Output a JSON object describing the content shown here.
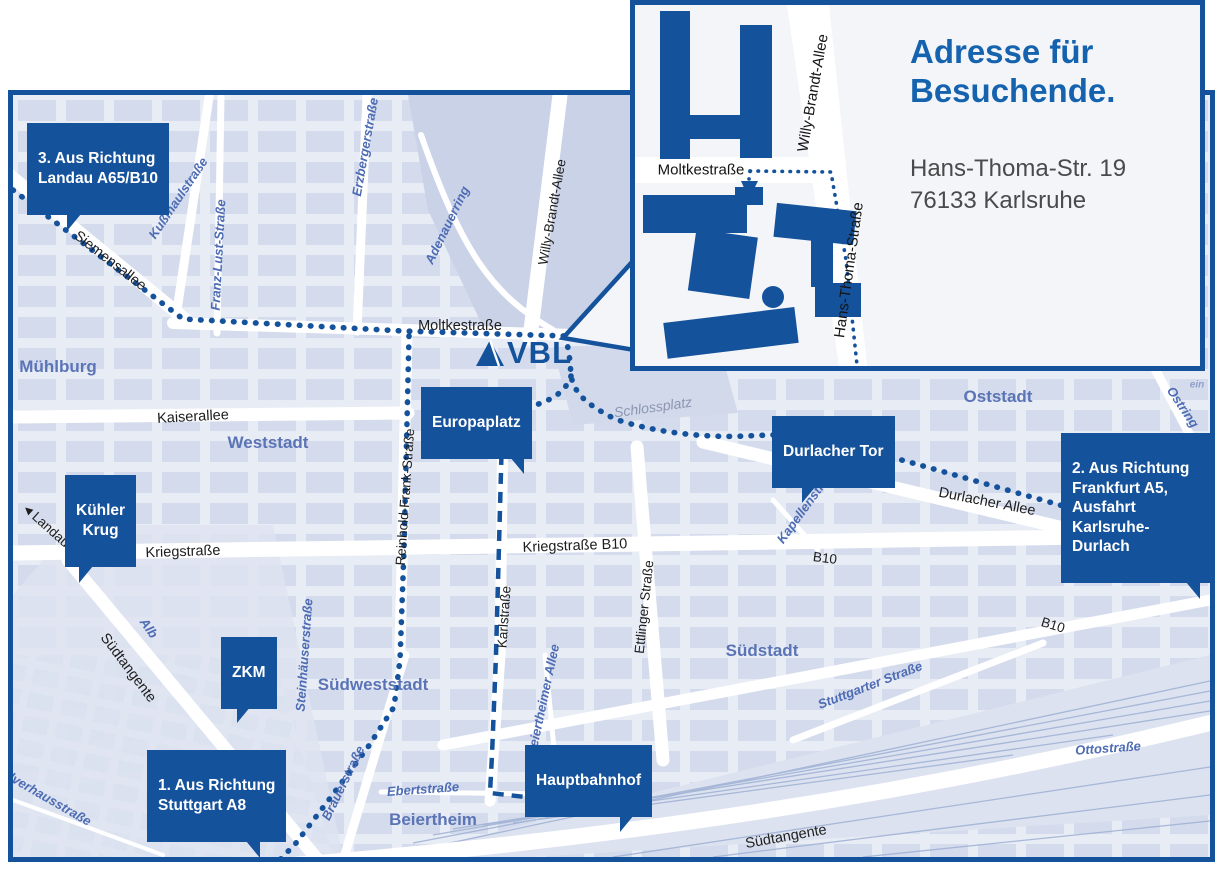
{
  "colors": {
    "accent": "#15529c",
    "title_blue": "#1563ae",
    "map_bg": "#e8ecf5",
    "block": "#cfd7ea",
    "street_blue_text": "#4d6cb4",
    "district_text": "#5b74b6"
  },
  "inset": {
    "title": "Adresse für\nBesuchende.",
    "address_line1": "Hans-Thoma-Str. 19",
    "address_line2": "76133 Karlsruhe",
    "streets": {
      "moltkestrasse": "Moltkestraße",
      "willy_brandt_allee": "Willy-Brandt-Allee",
      "hans_thoma_strasse": "Hans-Thoma-Straße"
    },
    "entrance_arrow": "▼"
  },
  "logo": {
    "text": "VBL"
  },
  "callouts": {
    "route3": "3. Aus Richtung\nLandau A65/B10",
    "route1": "1. Aus Richtung\nStuttgart A8",
    "route2": "2. Aus Richtung\nFrankfurt A5,\nAusfahrt\nKarlsruhe-Durlach",
    "kuehler_krug": "Kühler\nKrug",
    "zkm": "ZKM",
    "europaplatz": "Europaplatz",
    "durlacher_tor": "Durlacher Tor",
    "hauptbahnhof": "Hauptbahnhof"
  },
  "streets_black": {
    "siemensallee": "Siemensallee",
    "moltkestrasse": "Moltkestraße",
    "kaiserallee": "Kaiserallee",
    "kriegstrasse": "Kriegstraße",
    "kriegstrasse_b10": "Kriegstraße B10",
    "b10": "B10",
    "reinhold_frank_strasse": "Reinhold-Frank-Straße",
    "karlstrasse": "Karlstraße",
    "ettlinger_strasse": "Ettlinger Straße",
    "willy_brandt_allee": "Willy-Brandt-Allee",
    "durlacher_allee": "Durlacher Allee",
    "suedtangente": "Südtangente",
    "landau_b10": "Landau B10",
    "landau_arrow": "◀"
  },
  "streets_blue": {
    "kussmaulstrasse": "Kußmaulstraße",
    "franz_lust_strasse": "Franz-Lust-Straße",
    "erzbergerstrasse": "Erzbergerstraße",
    "adenauerring": "Adenauerring",
    "kapellenstrasse": "Kapellenstraße",
    "ostring": "Ostring",
    "steinhaeuserstrasse": "Steinhäuserstraße",
    "brauerstrasse": "Brauerstraße",
    "ebertstrasse": "Ebertstraße",
    "beiertheimer_allee": "Beiertheimer Allee",
    "stuttgarter_strasse": "Stuttgarter Straße",
    "ottostrasse": "Ottostraße",
    "alb": "Alb",
    "pulverhausstrasse": "Pulverhausstraße"
  },
  "places_gray": {
    "schlossplatz": "Schlossplatz"
  },
  "districts": {
    "muehlburg": "Mühlburg",
    "weststadt": "Weststadt",
    "oststadt": "Oststadt",
    "suedstadt": "Südstadt",
    "suedweststadt": "Südweststadt",
    "beiertheim": "Beiertheim"
  },
  "edge_fragments": {
    "f1": "Hai",
    "f2": "we",
    "f3": "ein"
  }
}
